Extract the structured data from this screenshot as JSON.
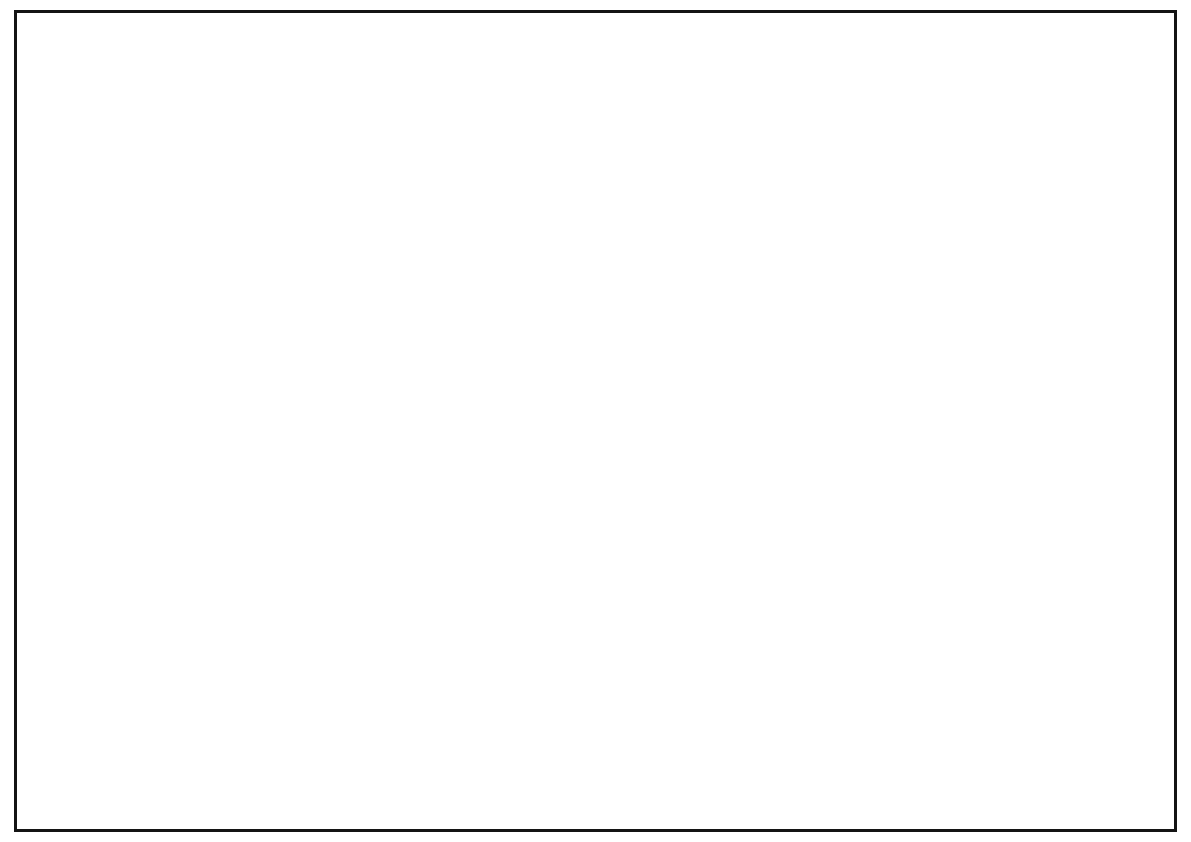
{
  "sheet": {
    "background": "#ffffff",
    "border_color": "#141414"
  },
  "title_block": {
    "note": {
      "title": "注",
      "body": "　装修效果图以此图纸为依据　材料以施工图为准　如有更改需通知设计师　装修现场不得遮挡和破坏消防器材"
    },
    "rows": [
      {
        "label": "铺位号"
      },
      {
        "label": "店　名"
      },
      {
        "label": "业　态"
      },
      {
        "label": "面　积"
      },
      {
        "label": "业　主"
      },
      {
        "label": "设计部"
      },
      {
        "label": "经　营"
      },
      {
        "label": "总经理"
      }
    ]
  },
  "render": {
    "subject": "office-atrium-interior-axonometric",
    "floor": {
      "palette_white": [
        "#f5f5f3",
        "#f1f1ef",
        "#ececea"
      ],
      "palette_light": "#e0e0de",
      "palette_mid": [
        "#98999b",
        "#7d8082"
      ],
      "palette_dark": [
        "#1d1f21",
        "#26282a",
        "#141618"
      ],
      "wing_palette": [
        "#f3f3f1",
        "#ebebe9",
        "#e3e3e1"
      ]
    },
    "colors": {
      "wall_face": "#d8d7d3",
      "wall_cap": "#e9e9e7",
      "wall_gray": "#c9c8c4",
      "wood_floor": "#a07550",
      "desk_wood": "#cfa46c",
      "shelf_wood": "#c89e66",
      "roof_wood": "#b5824e",
      "lattice_dark": "#5a3a24",
      "feature_wall": "#a9743f",
      "pond_water": "#46555e",
      "plant_green": "#8fbf6a",
      "planter_wood": "#8a5a33",
      "panel_black": "#111111",
      "chair_black": "#1f1f1f",
      "seat_cream": "#e9dcc0",
      "model_green": "#7cab52",
      "model_river": "#5d8fb4"
    }
  }
}
